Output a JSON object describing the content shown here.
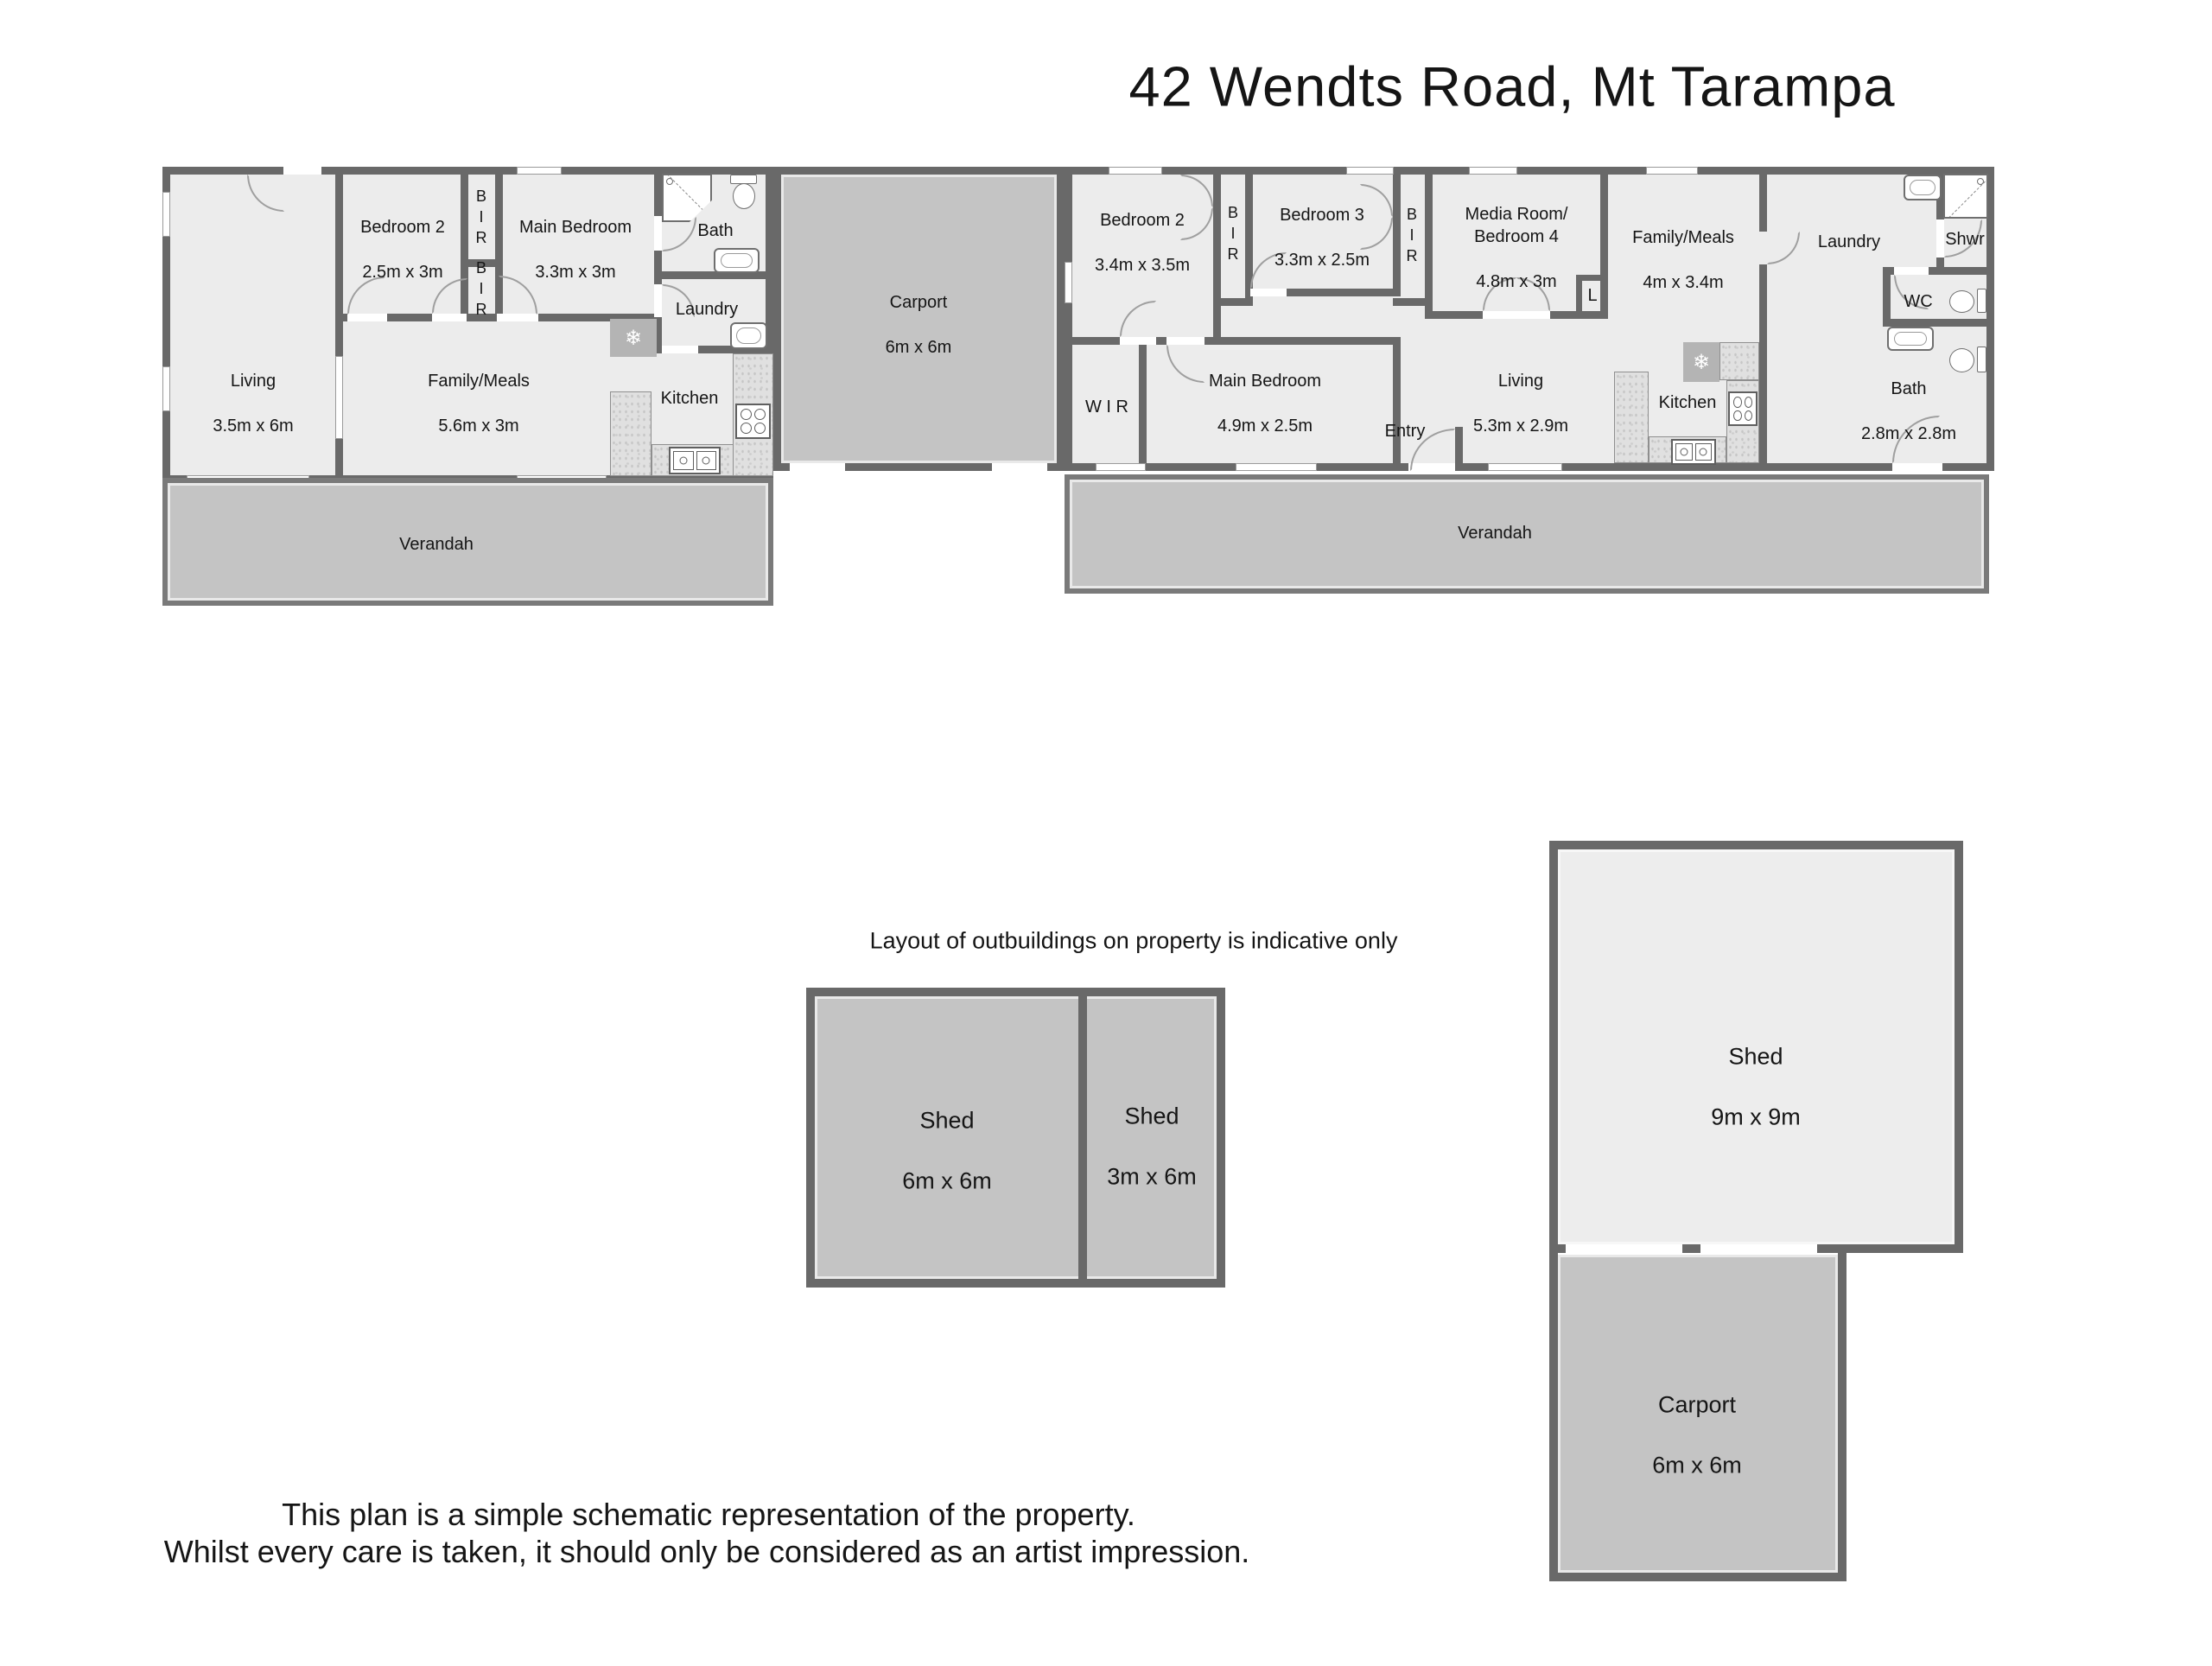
{
  "title": "42 Wendts Road, Mt Tarampa",
  "notes": {
    "outbuildings": "Layout of outbuildings on property is indicative only",
    "disclaimer1": "This plan is a simple schematic representation of the property.",
    "disclaimer2": "Whilst every care is taken, it should only be considered as an artist impression."
  },
  "colors": {
    "wall": "#696969",
    "room_fill": "#ececec",
    "outdoor_fill": "#c4c4c4",
    "shed_fill": "#ededed",
    "text": "#151515"
  },
  "icons": {
    "snowflake": "❄"
  },
  "house1": {
    "living": {
      "name": "Living",
      "dims": "3.5m x 6m"
    },
    "bedroom2": {
      "name": "Bedroom 2",
      "dims": "2.5m x 3m"
    },
    "bir_upper": {
      "name": "B\nI\nR"
    },
    "bir_lower": {
      "name": "B\nI\nR"
    },
    "main_bedroom": {
      "name": "Main Bedroom",
      "dims": "3.3m x 3m"
    },
    "bath": {
      "name": "Bath"
    },
    "laundry": {
      "name": "Laundry"
    },
    "family_meals": {
      "name": "Family/Meals",
      "dims": "5.6m x 3m"
    },
    "kitchen": {
      "name": "Kitchen"
    },
    "verandah": {
      "name": "Verandah"
    }
  },
  "carport_between": {
    "name": "Carport",
    "dims": "6m x 6m"
  },
  "house2": {
    "bedroom2": {
      "name": "Bedroom 2",
      "dims": "3.4m x 3.5m"
    },
    "bir_left": {
      "name": "B\nI\nR"
    },
    "bedroom3": {
      "name": "Bedroom 3",
      "dims": "3.3m x 2.5m"
    },
    "bir_right": {
      "name": "B\nI\nR"
    },
    "media_room": {
      "name": "Media Room/\nBedroom 4",
      "dims": "4.8m x 3m"
    },
    "linen": {
      "name": "L"
    },
    "family_meals": {
      "name": "Family/Meals",
      "dims": "4m x 3.4m"
    },
    "laundry": {
      "name": "Laundry"
    },
    "shower": {
      "name": "Shwr"
    },
    "wc": {
      "name": "WC"
    },
    "bath": {
      "name": "Bath",
      "dims": "2.8m x 2.8m"
    },
    "wir": {
      "name": "W I R"
    },
    "main_bedroom": {
      "name": "Main Bedroom",
      "dims": "4.9m x 2.5m"
    },
    "entry": {
      "name": "Entry"
    },
    "living": {
      "name": "Living",
      "dims": "5.3m x 2.9m"
    },
    "kitchen": {
      "name": "Kitchen"
    },
    "verandah": {
      "name": "Verandah"
    }
  },
  "outbuildings": {
    "shed_6x6": {
      "name": "Shed",
      "dims": "6m x 6m"
    },
    "shed_3x6": {
      "name": "Shed",
      "dims": "3m x 6m"
    },
    "shed_9x9": {
      "name": "Shed",
      "dims": "9m x 9m"
    },
    "carport": {
      "name": "Carport",
      "dims": "6m x 6m"
    }
  }
}
